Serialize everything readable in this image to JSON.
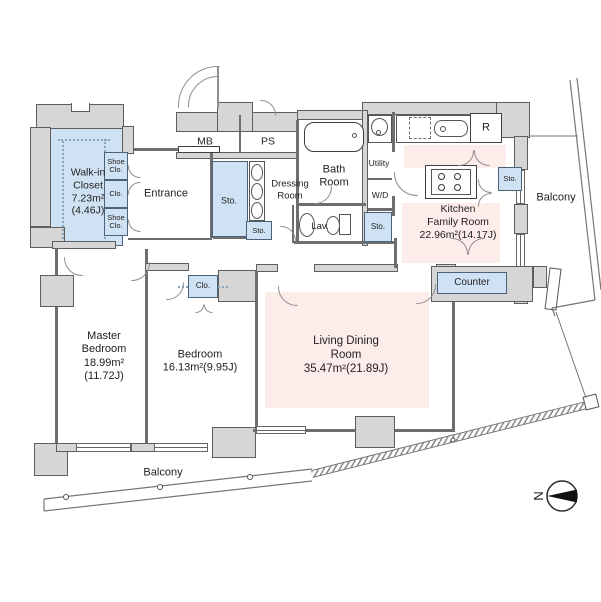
{
  "plan": {
    "rooms": {
      "walk_in_closet": {
        "name": [
          "Walk-in",
          "Closet"
        ],
        "area": "7.23m²",
        "tatami": "(4.46J)"
      },
      "entrance": {
        "name": "Entrance"
      },
      "mb": {
        "name": "MB"
      },
      "ps": {
        "name": "PS"
      },
      "dressing_room": {
        "name": [
          "Dressing",
          "Room"
        ]
      },
      "bath_room": {
        "name": [
          "Bath",
          "Room"
        ]
      },
      "utility": {
        "name": "Utility"
      },
      "washer_dryer": {
        "name": "W/D"
      },
      "lavatory": {
        "name": "Lav."
      },
      "refrigerator": {
        "name": "R"
      },
      "kitchen": {
        "name": [
          "Kitchen",
          "Family Room"
        ],
        "area": "22.96m²(14.17J)"
      },
      "counter": {
        "name": "Counter"
      },
      "master_bedroom": {
        "name": [
          "Master",
          "Bedroom"
        ],
        "area": "18.99m²",
        "tatami": "(11.72J)"
      },
      "bedroom": {
        "name": "Bedroom",
        "area": "16.13m²(9.95J)"
      },
      "living_dining": {
        "name": [
          "Living Dining",
          "Room"
        ],
        "area": "35.47m²(21.89J)"
      },
      "balcony_right": {
        "name": "Balcony"
      },
      "balcony_bottom": {
        "name": "Balcony"
      }
    },
    "storage": {
      "shoe_closet_top": "Shoe Clo.",
      "closet_entry": "Clo.",
      "shoe_closet_bottom": "Shoe Clo.",
      "storage_hall": "Sto.",
      "storage_hall_small": "Sto.",
      "storage_lavatory": "Sto.",
      "storage_kitchen": "Sto.",
      "closet_bedroom": "Clo."
    },
    "compass": {
      "north": "N"
    },
    "colors": {
      "wall_fill": "#d6d6d6",
      "room_blue": "#cfe2f3",
      "room_pink": "#fcecea"
    }
  }
}
